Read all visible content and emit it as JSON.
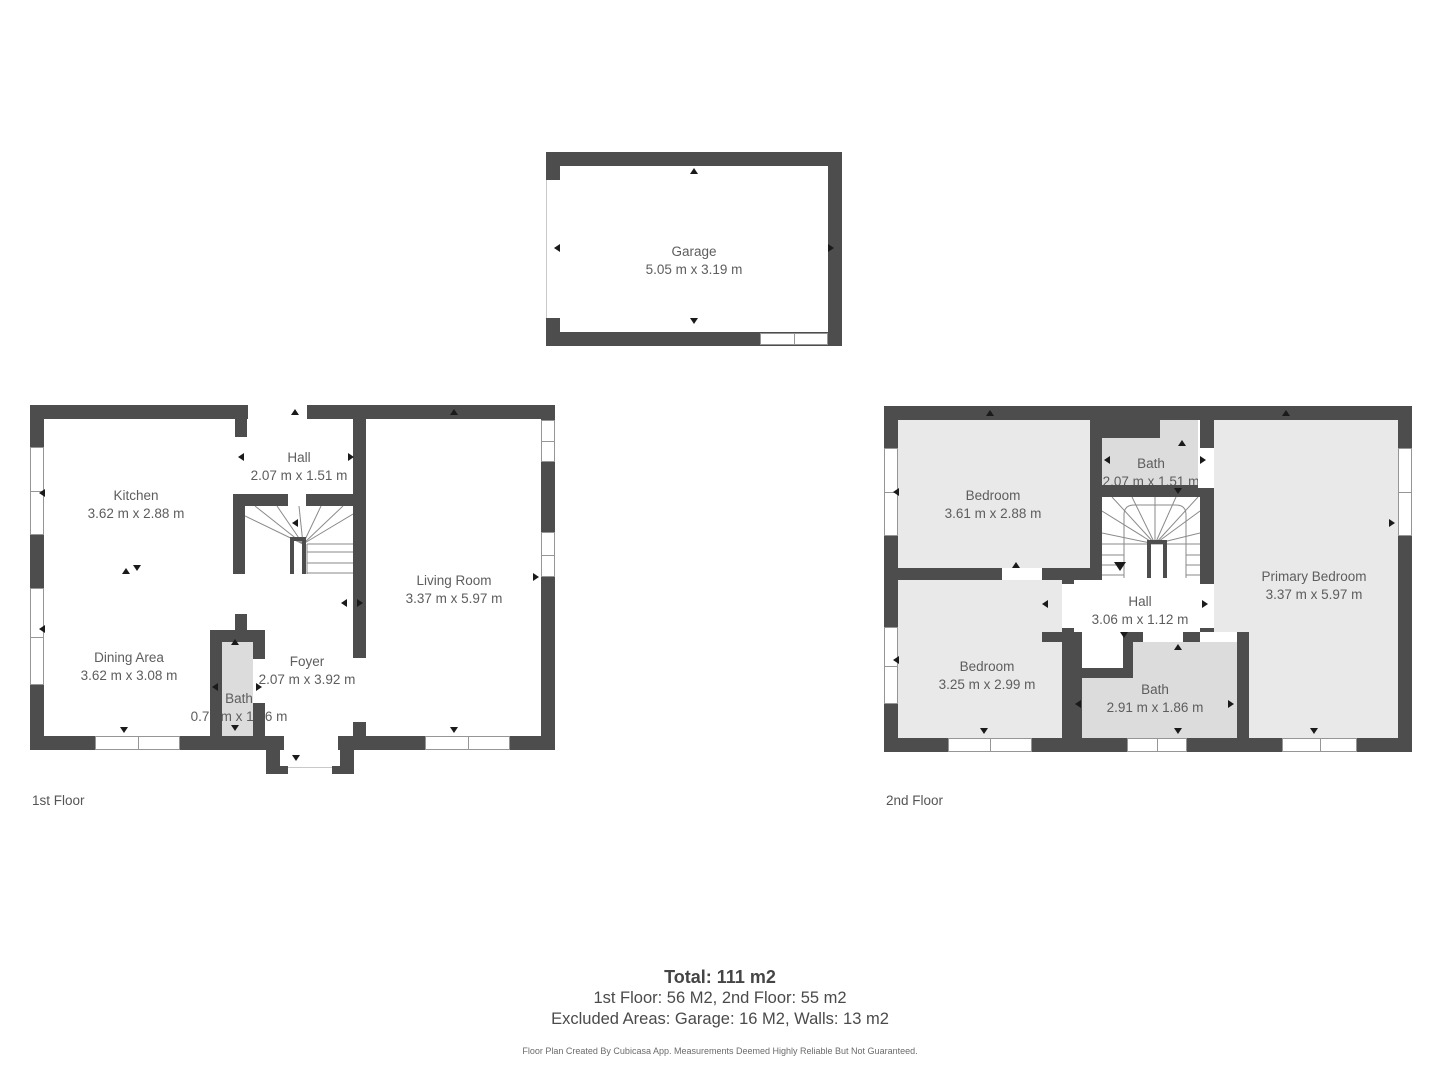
{
  "garage": {
    "name": "Garage",
    "dims": "5.05 m x 3.19 m"
  },
  "floors": [
    {
      "label": "1st Floor",
      "rooms": [
        {
          "name": "Kitchen",
          "dims": "3.62 m x 2.88 m"
        },
        {
          "name": "Hall",
          "dims": "2.07 m x 1.51 m"
        },
        {
          "name": "Living Room",
          "dims": "3.37 m x 5.97 m"
        },
        {
          "name": "Dining Area",
          "dims": "3.62 m x 3.08 m"
        },
        {
          "name": "Bath",
          "dims": "0.77 m x 1.96 m"
        },
        {
          "name": "Foyer",
          "dims": "2.07 m x 3.92 m"
        }
      ]
    },
    {
      "label": "2nd Floor",
      "rooms": [
        {
          "name": "Bedroom",
          "dims": "3.61 m x 2.88 m"
        },
        {
          "name": "Bath",
          "dims": "2.07 m x 1.51 m"
        },
        {
          "name": "Primary Bedroom",
          "dims": "3.37 m x 5.97 m"
        },
        {
          "name": "Hall",
          "dims": "3.06 m x 1.12 m"
        },
        {
          "name": "Bedroom",
          "dims": "3.25 m x 2.99 m"
        },
        {
          "name": "Bath",
          "dims": "2.91 m x 1.86 m"
        }
      ]
    }
  ],
  "summary": {
    "total": "Total: 111 m2",
    "line1": "1st Floor: 56 M2, 2nd Floor: 55 m2",
    "line2": "Excluded Areas: Garage: 16 M2, Walls: 13 m2",
    "disclaimer": "Floor Plan Created By Cubicasa App. Measurements Deemed Highly Reliable But Not Guaranteed."
  },
  "colors": {
    "wall": "#4d4d4d",
    "room_fill": "#e9e9e9",
    "bath_fill": "#dcdcdc",
    "text": "#5d5d5d"
  }
}
